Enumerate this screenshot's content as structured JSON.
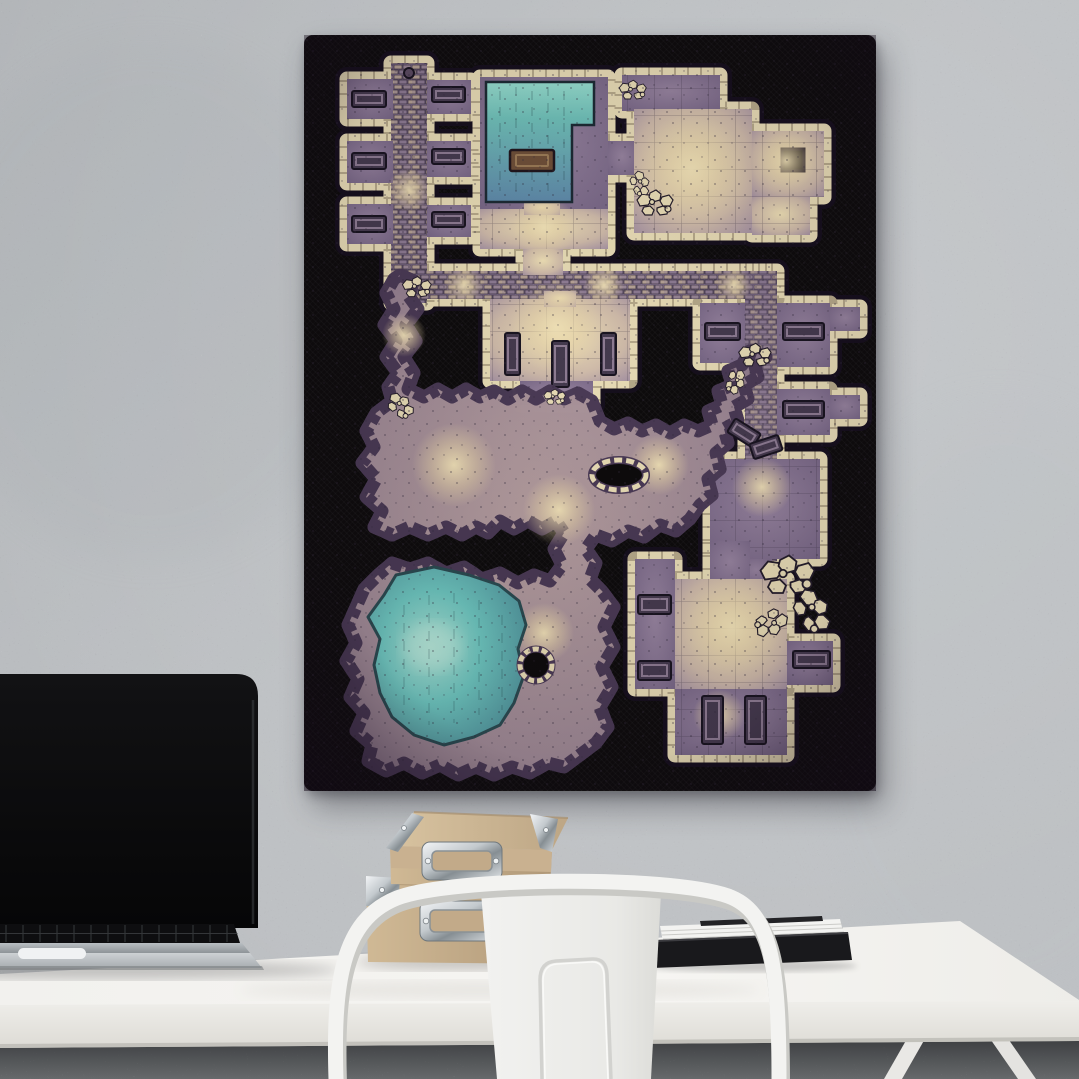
{
  "meta": {
    "description": "Product-style photo: black portrait canvas print of a hand-drawn fantasy dungeon battle map hanging on a speckled concrete wall above a white desk with a laptop, two kraft storage boxes, a document stack and a white metal cafe chair.",
    "visible_text": "none"
  },
  "colors": {
    "wall": "#cdd1d5",
    "floor": "#8f9396",
    "desk_top": "#f5f4f1",
    "desk_front": "#eae8e4",
    "canvas_bg": "#0d0b0c",
    "map_stone": "#e6dab4",
    "map_floor": "#8b7991",
    "map_floor_light": "#ecdcb0",
    "map_water_light": "#93dacc",
    "map_water_deep": "#5e88a8",
    "map_lake": "#6cc4bd",
    "map_cave": "#a18d93",
    "laptop_screen": "#0a0a0b",
    "laptop_silver": "#a8adb1",
    "box_kraft": "#c6ae8d",
    "metal_light": "#e9ecee",
    "chair_white": "#f2f2f0",
    "paper": "#f3f3f1",
    "folder_black": "#19191c"
  },
  "objects": {
    "wall": {
      "label": "Light gray speckled concrete wall"
    },
    "floor": {
      "label": "Dark gray speckled floor"
    },
    "canvas_print": {
      "label": "Black canvas print of a dungeon battle map",
      "orientation": "portrait",
      "map": {
        "style": "hand-drawn fantasy dungeon / cavern battle map, cream stone walls, purple floors, teal water",
        "features": [
          {
            "id": "west-cell-block",
            "type": "rooms",
            "desc": "Vertical brick corridor with six prison cells, each with a dark stone bed, and a small top entry alcove"
          },
          {
            "id": "ritual-pool-room",
            "type": "room",
            "desc": "Large chamber almost filled by an L-shaped teal pool with a central stone slab and east walkway"
          },
          {
            "id": "northeast-hall",
            "type": "room",
            "desc": "Large tiled hall with rubble, side wing and a square black pit"
          },
          {
            "id": "main-corridor",
            "type": "corridor",
            "desc": "East-west brick-paved corridor linking both halves"
          },
          {
            "id": "barracks",
            "type": "room",
            "desc": "Room south of the corridor holding three vertical stone beds, stepped south exit"
          },
          {
            "id": "east-cell-corridor",
            "type": "corridor",
            "desc": "North-south corridor with bed cells on both sides, broken mid-way by a cave-in with toppled furniture"
          },
          {
            "id": "guard-room",
            "type": "room",
            "desc": "Square room on the east side connecting down to the southeast complex"
          },
          {
            "id": "cavern-network",
            "type": "cave",
            "desc": "Organic cavern passages with rocky cream edges, a ring passage around a stone island, linking corridor, barracks and east corridor"
          },
          {
            "id": "cavern-lake",
            "type": "water",
            "desc": "Large jagged teal underground lake with a bright centre and a small rocky sinkhole to its east"
          },
          {
            "id": "southeast-complex",
            "type": "rooms",
            "desc": "Bright tiled hall with bed alcoves left and right, large rubble pile breaching the northeast wall, and a lower chamber with two vertical bunks"
          }
        ]
      }
    },
    "desk": {
      "label": "White desk slab with trestle legs"
    },
    "laptop": {
      "label": "Open laptop with dark screen and silver keyboard deck"
    },
    "storage_boxes": {
      "label": "Two stacked kraft cardboard storage boxes with chrome label holders and corner guards"
    },
    "documents": {
      "label": "Stack of white papers on a black folder"
    },
    "chair": {
      "label": "White metal cafe chair with curved back bar and embossed backrest"
    }
  }
}
